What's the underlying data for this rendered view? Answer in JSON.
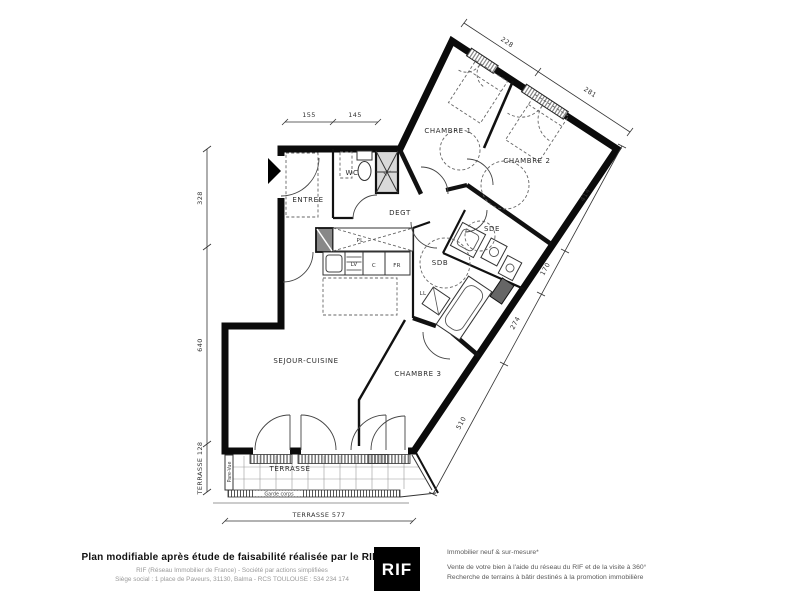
{
  "plan": {
    "rooms": {
      "chambre1": "CHAMBRE 1",
      "chambre2": "CHAMBRE 2",
      "chambre3": "CHAMBRE 3",
      "sejour": "SEJOUR-CUISINE",
      "entree": "ENTREE",
      "wc": "WC",
      "degt": "DEGT",
      "sdb": "SDB",
      "sde": "SDE",
      "terrasse": "TERRASSE"
    },
    "labels": {
      "pl_wc": "PL",
      "pl_kitchen": "PL",
      "lv": "LV",
      "cooker": "C",
      "fridge": "FR",
      "ll": "LL",
      "pare_vue": "Pare-Vue",
      "garde_corps": "Garde corps"
    },
    "dims": {
      "top_left": [
        "155",
        "145"
      ],
      "top": [
        "228",
        "281"
      ],
      "left": [
        "328",
        "640",
        "TERRASSE 128"
      ],
      "right": [
        "414",
        "170",
        "274",
        "510"
      ],
      "bottom": "TERRASSE 577"
    }
  },
  "footer": {
    "title": "Plan modifiable après étude de faisabilité réalisée par le RIF",
    "line1": "RIF (Réseau  Immobilier de France)  - Société par actions simplifiées",
    "line2": "Siège social : 1 place de Paveurs, 31130,  Balma - RCS TOULOUSE : 534 234 174",
    "logo": "RIF",
    "right1": "Immobilier neuf & sur-mesure*",
    "right2": "Vente de votre bien à l'aide du réseau du RIF et de la visite à 360°",
    "right3": "Recherche de terrains à bâtir destinés à la promotion immobilière"
  }
}
